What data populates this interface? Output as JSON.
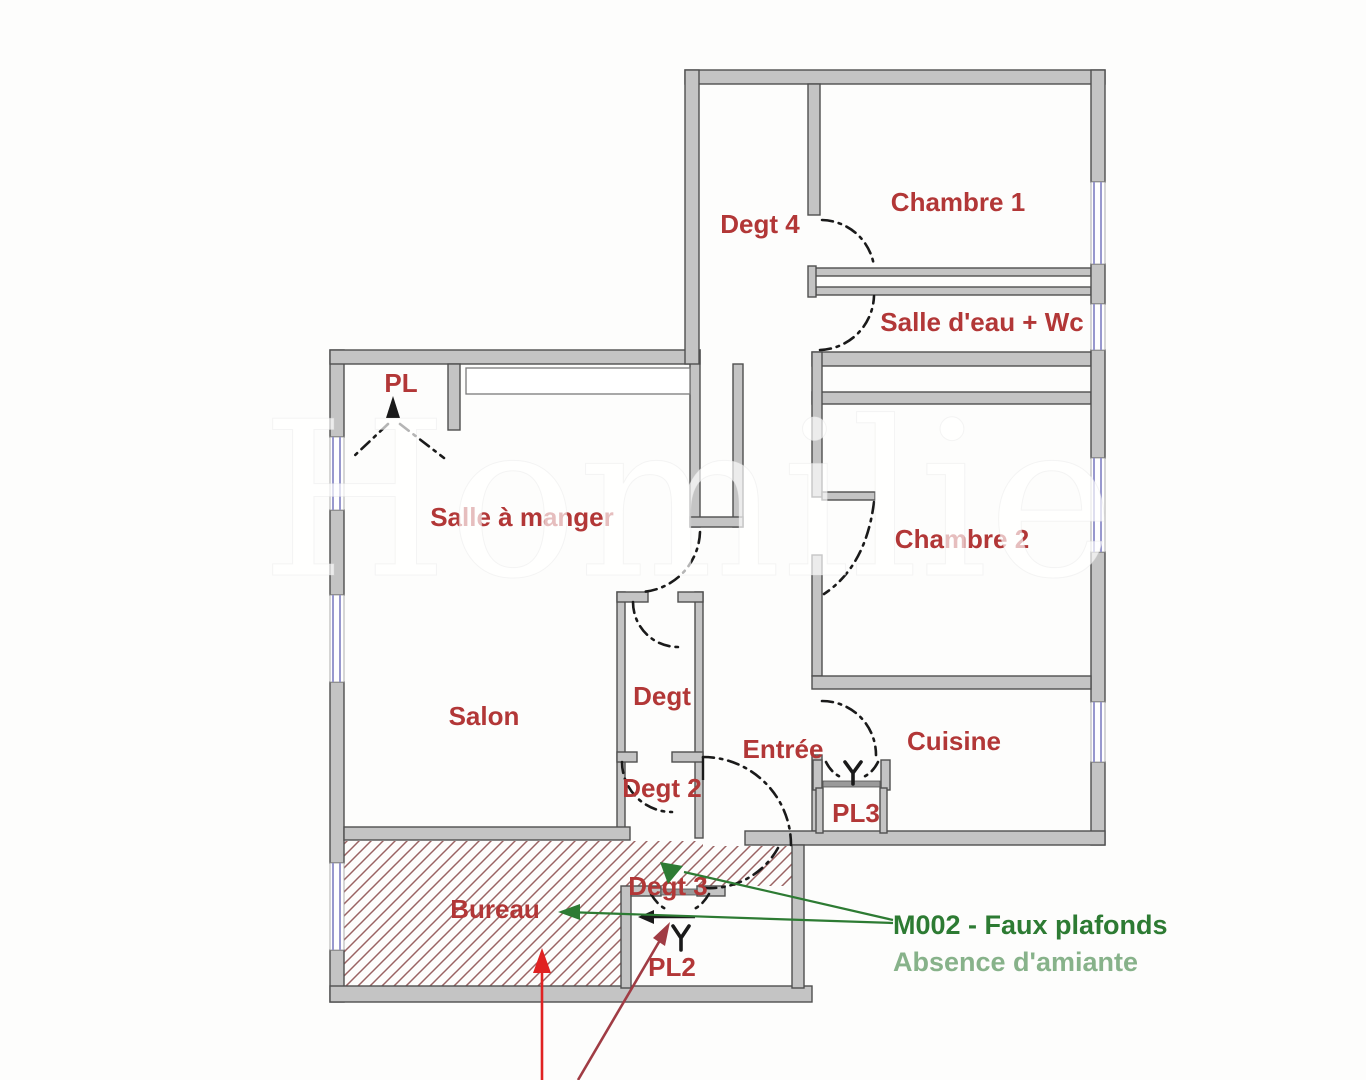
{
  "page": {
    "background": "#fdfdfc"
  },
  "watermark": {
    "text": "Homilie"
  },
  "plan": {
    "colors": {
      "wall_fill": "#c4c4c4",
      "wall_stroke": "#4f4f4f",
      "label": "#b23737",
      "door": "#1a1a1a",
      "window": "#8d8dc8",
      "hatch": "#9a6363"
    },
    "rooms": [
      {
        "id": "pl",
        "label": "PL"
      },
      {
        "id": "degt-4",
        "label": "Degt 4"
      },
      {
        "id": "chambre-1",
        "label": "Chambre 1"
      },
      {
        "id": "salle-eau-wc",
        "label": "Salle d'eau + Wc"
      },
      {
        "id": "salle-a-manger",
        "label": "Salle à manger"
      },
      {
        "id": "chambre-2",
        "label": "Chambre 2"
      },
      {
        "id": "salon",
        "label": "Salon"
      },
      {
        "id": "degt",
        "label": "Degt"
      },
      {
        "id": "degt-2",
        "label": "Degt 2"
      },
      {
        "id": "entree",
        "label": "Entrée"
      },
      {
        "id": "cuisine",
        "label": "Cuisine"
      },
      {
        "id": "pl3",
        "label": "PL3"
      },
      {
        "id": "bureau",
        "label": "Bureau"
      },
      {
        "id": "degt-3",
        "label": "Degt 3"
      },
      {
        "id": "pl2",
        "label": "PL2"
      }
    ]
  },
  "annotations": {
    "measure_label": "M002 - Faux plafonds",
    "measure_sublabel": "Absence d'amiante",
    "colors": {
      "primary": "#2d7b33",
      "secondary": "#87b28a",
      "arrow_red": "#e02222",
      "arrow_dark_red": "#a03c44"
    }
  }
}
